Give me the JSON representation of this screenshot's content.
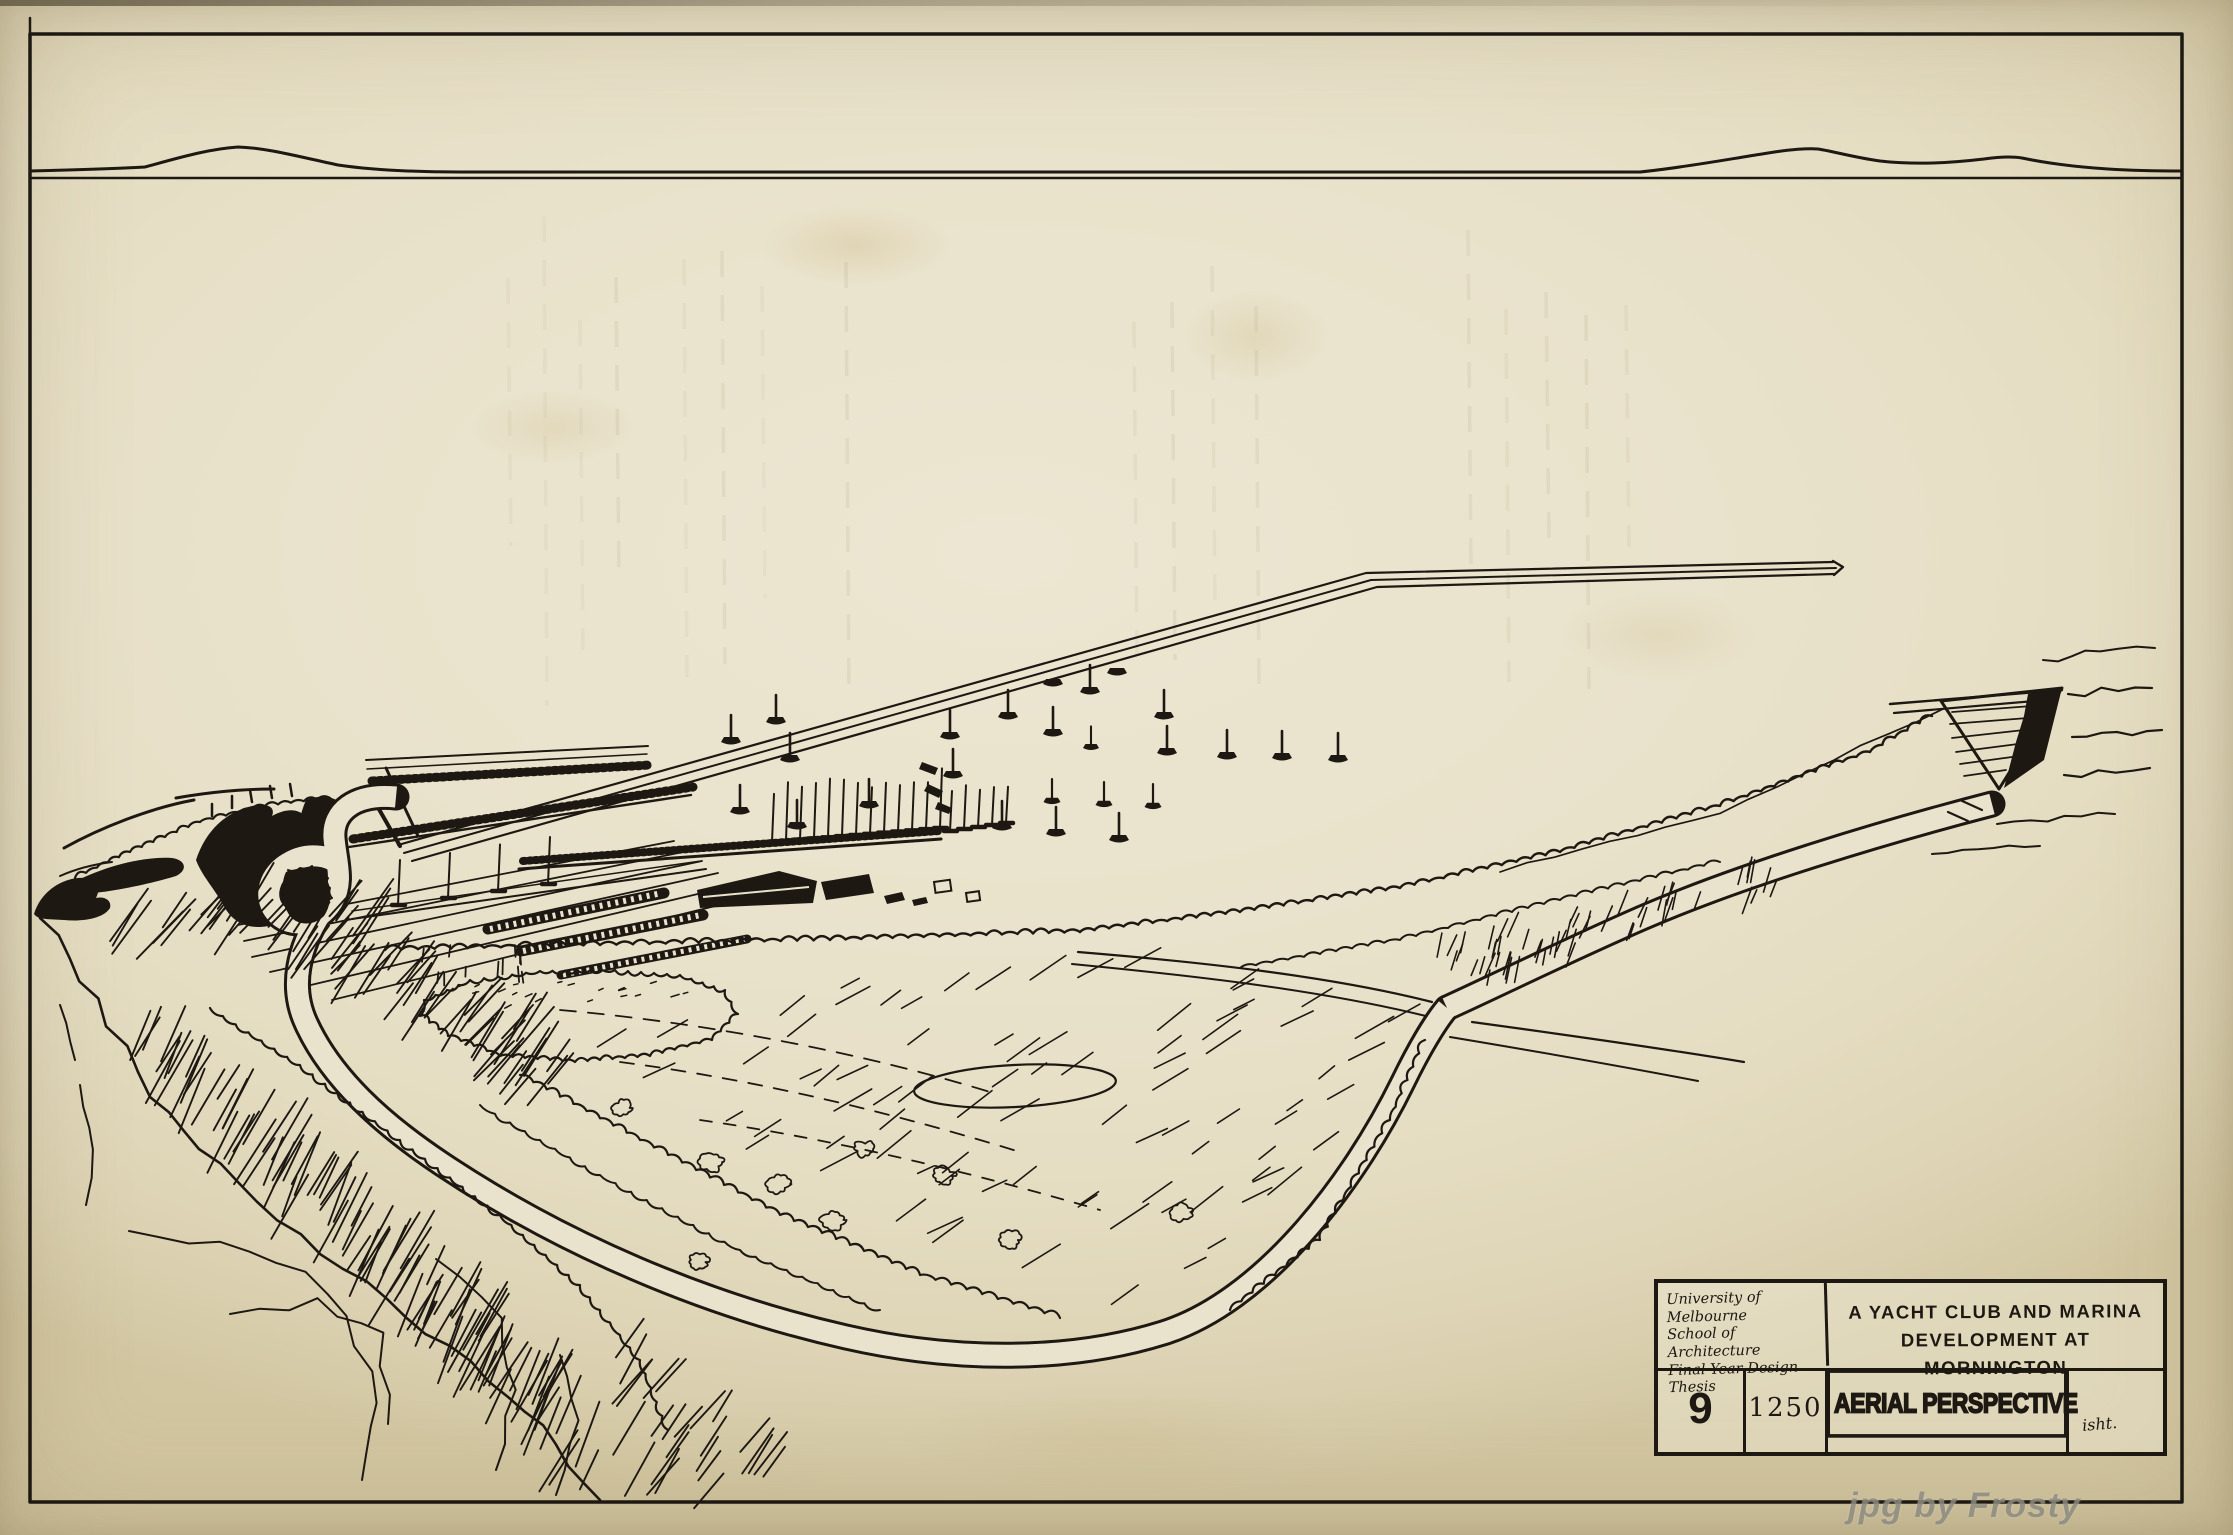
{
  "title_block": {
    "institution": [
      "University of Melbourne",
      "School of Architecture",
      "Final Year Design Thesis"
    ],
    "project_title": [
      "A YACHT CLUB AND MARINA",
      "DEVELOPMENT AT MORNINGTON"
    ],
    "sheet_number": "9",
    "scale": "1250",
    "drawing_title": "AERIAL PERSPECTIVE",
    "signature": "isht."
  },
  "watermark": {
    "text": "jpg by Frosty",
    "color": "#8d8b80"
  },
  "colors": {
    "ink": "#1d1812",
    "paper": "#e8e1c8",
    "paper_light": "#ece6d2"
  }
}
